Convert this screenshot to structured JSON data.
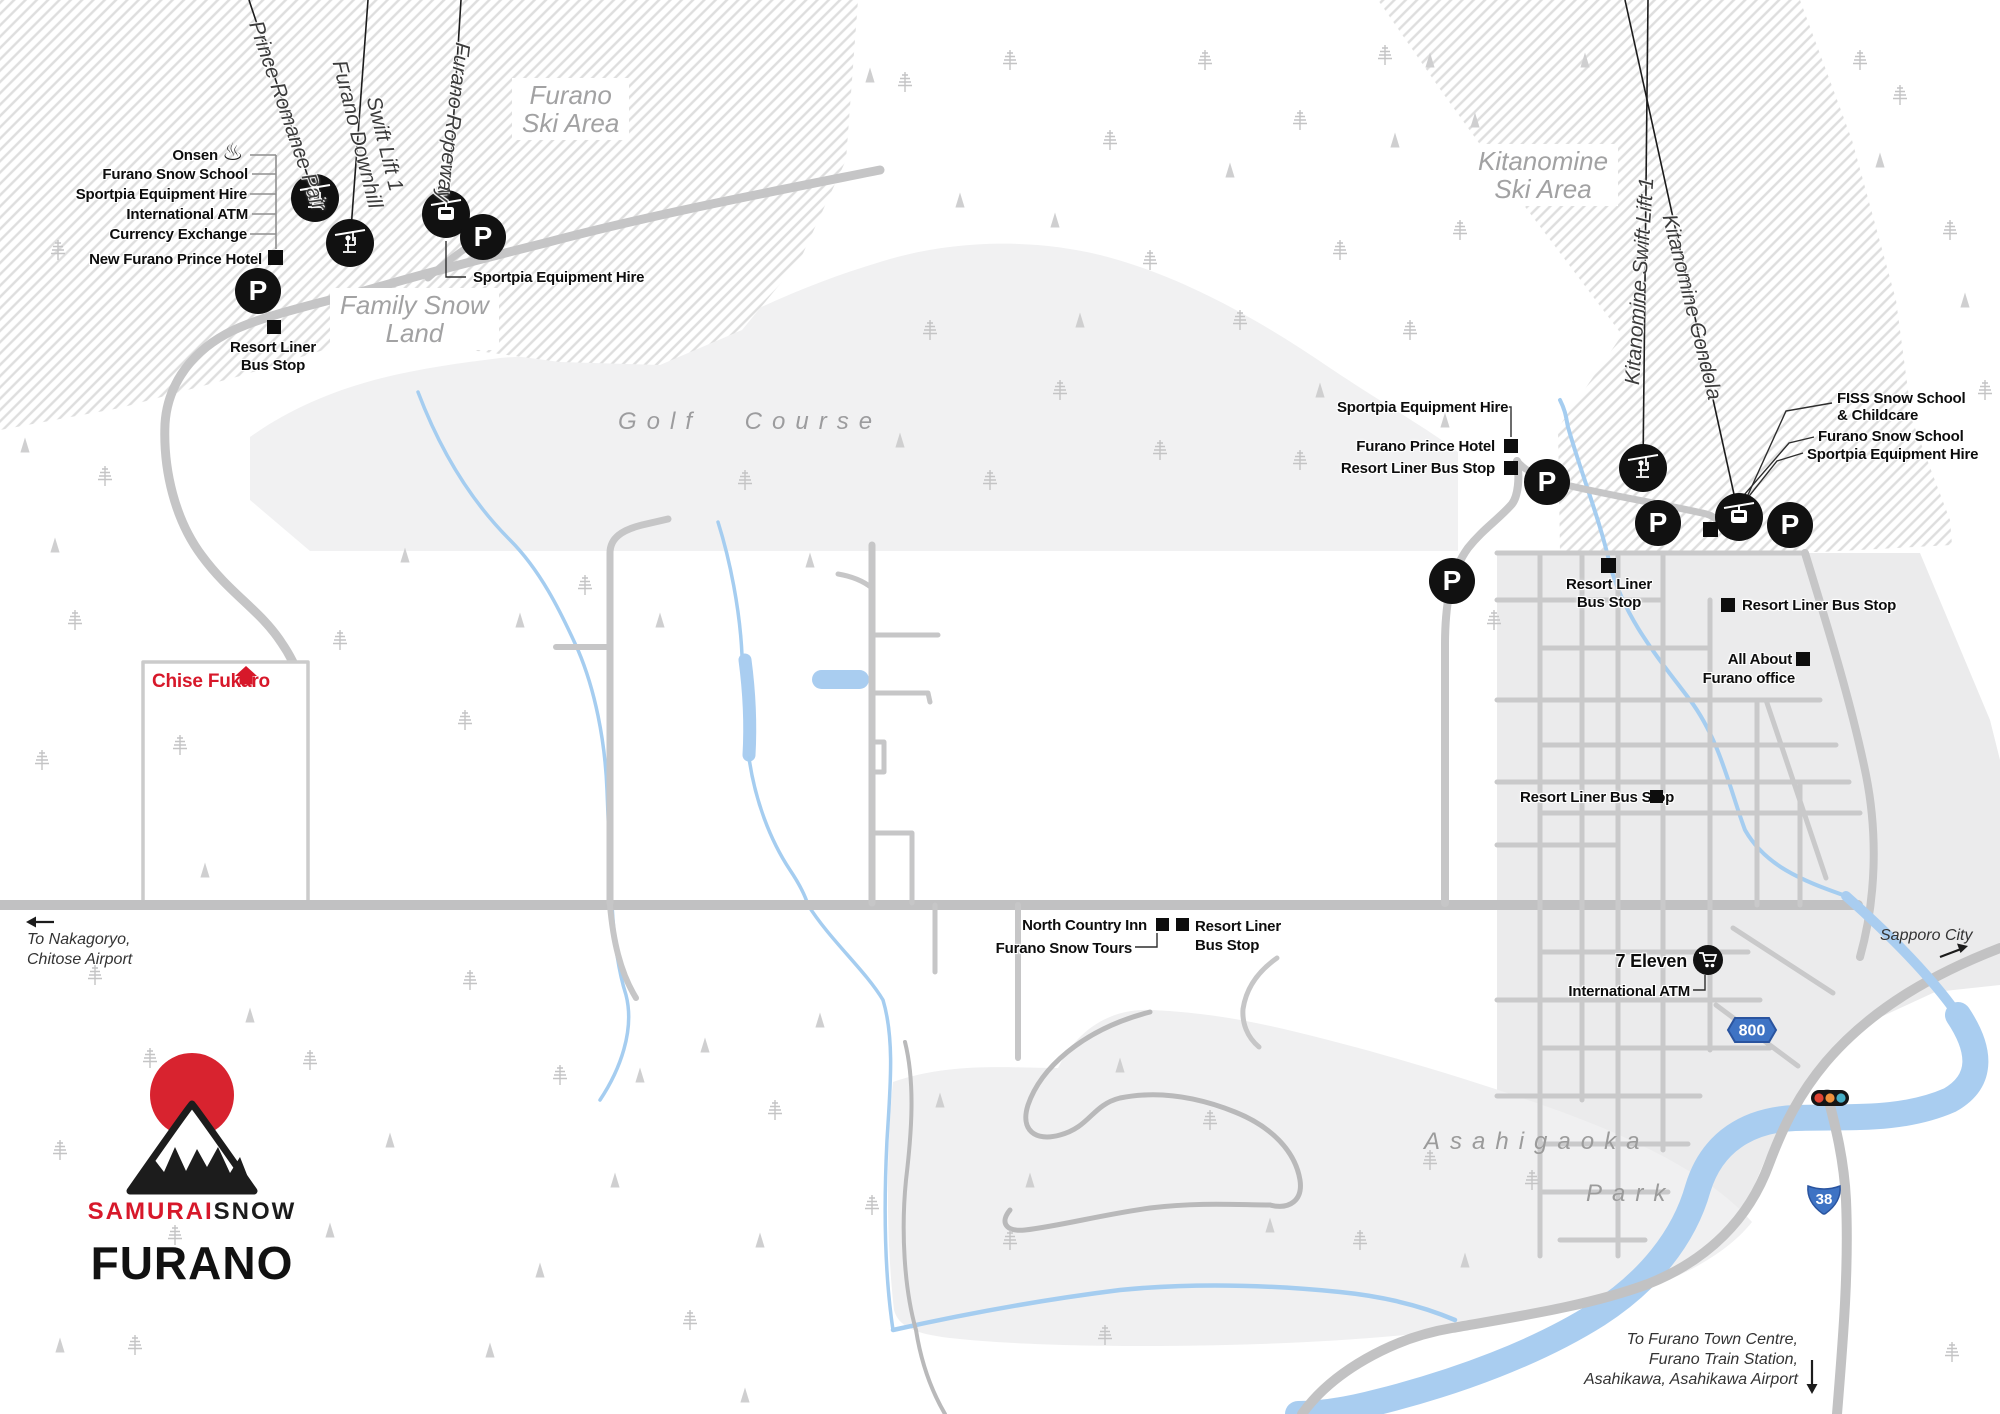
{
  "colors": {
    "accent_red": "#d7182a",
    "route_shield_blue": "#3e73c4",
    "river_blue": "#a9cdf0",
    "road_gray": "#c6c6c7",
    "area_label_gray": "#a2a2a3",
    "poi_black": "#0d0d0d"
  },
  "logo": {
    "samurai": "SAMURAI",
    "snow": "SNOW",
    "resort_name": "FURANO"
  },
  "areas": {
    "furano_ski_area_1": "Furano",
    "furano_ski_area_2": "Ski Area",
    "kitanomine_ski_area_1": "Kitanomine",
    "kitanomine_ski_area_2": "Ski Area",
    "family_snow_land_1": "Family Snow",
    "family_snow_land_2": "Land",
    "golf_course": "Golf Course",
    "asahigaoka": "Asahigaoka",
    "park": "Park"
  },
  "lifts": {
    "prince_romance_pair": "Prince Romance Pair",
    "furano_downhill": "Furano Downhill",
    "furano_downhill_2": "Swift Lift 1",
    "furano_ropeway": "Furano Ropeway",
    "kitanomine_swift_lift": "Kitanomine Swift Lift 1",
    "kitanomine_gondola": "Kitanomine Gondola"
  },
  "poi": {
    "onsen": "Onsen",
    "furano_snow_school_left": "Furano Snow School",
    "sportpia_left": "Sportpia Equipment Hire",
    "intl_atm_left": "International ATM",
    "currency_exchange": "Currency Exchange",
    "new_furano_prince_hotel": "New Furano Prince Hotel",
    "resort_liner_left_1": "Resort Liner",
    "resort_liner_left_2": "Bus Stop",
    "sportpia_ropeway": "Sportpia Equipment Hire",
    "sportpia_kitanomine": "Sportpia Equipment Hire",
    "furano_prince_hotel": "Furano Prince Hotel",
    "resort_liner_prince": "Resort Liner Bus Stop",
    "fiss_1": "FISS Snow School",
    "fiss_2": "& Childcare",
    "furano_snow_school_right": "Furano Snow School",
    "sportpia_gondola": "Sportpia Equipment Hire",
    "resort_liner_town_nw_1": "Resort Liner",
    "resort_liner_town_nw_2": "Bus Stop",
    "resort_liner_town_ne": "Resort Liner Bus Stop",
    "all_about_1": "All About",
    "all_about_2": "Furano office",
    "resort_liner_town_mid": "Resort Liner Bus Stop",
    "north_country_inn": "North Country Inn",
    "resort_liner_nci_1": "Resort Liner",
    "resort_liner_nci_2": "Bus Stop",
    "furano_snow_tours": "Furano Snow Tours",
    "seven_eleven": "7 Eleven",
    "intl_atm_town": "International ATM",
    "chise_fukaro": "Chise Fukaro"
  },
  "directions": {
    "nakagoryo_1": "To Nakagoryo,",
    "nakagoryo_2": "Chitose Airport",
    "sapporo": "Sapporo City",
    "town_1": "To Furano Town Centre,",
    "town_2": "Furano Train Station,",
    "town_3": "Asahikawa, Asahikawa Airport"
  },
  "routes": {
    "prefectural_road": "800",
    "national_route": "38"
  },
  "markers": {
    "parking": "P"
  }
}
